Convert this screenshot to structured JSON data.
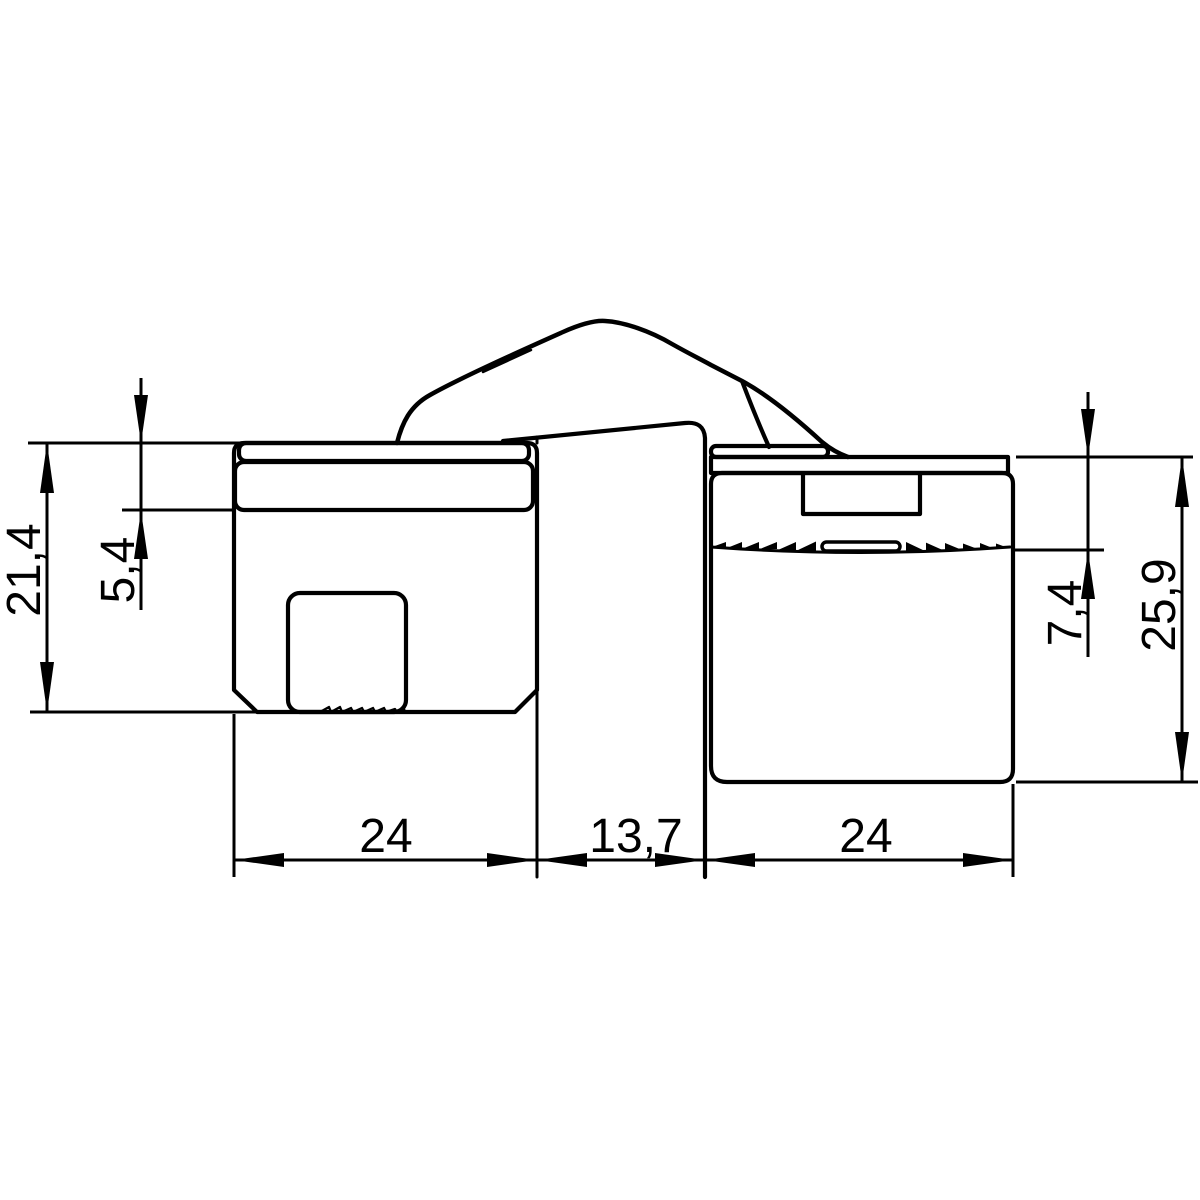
{
  "drawing": {
    "kind": "technical-dimension-drawing",
    "colors": {
      "line": "#000000",
      "background": "#ffffff"
    },
    "dimension_labels": {
      "left_height": "21,4",
      "left_plate_thickness": "5,4",
      "left_width": "24",
      "gap_width": "13,7",
      "right_width": "24",
      "right_recess_depth": "7,4",
      "right_height": "25,9"
    }
  }
}
